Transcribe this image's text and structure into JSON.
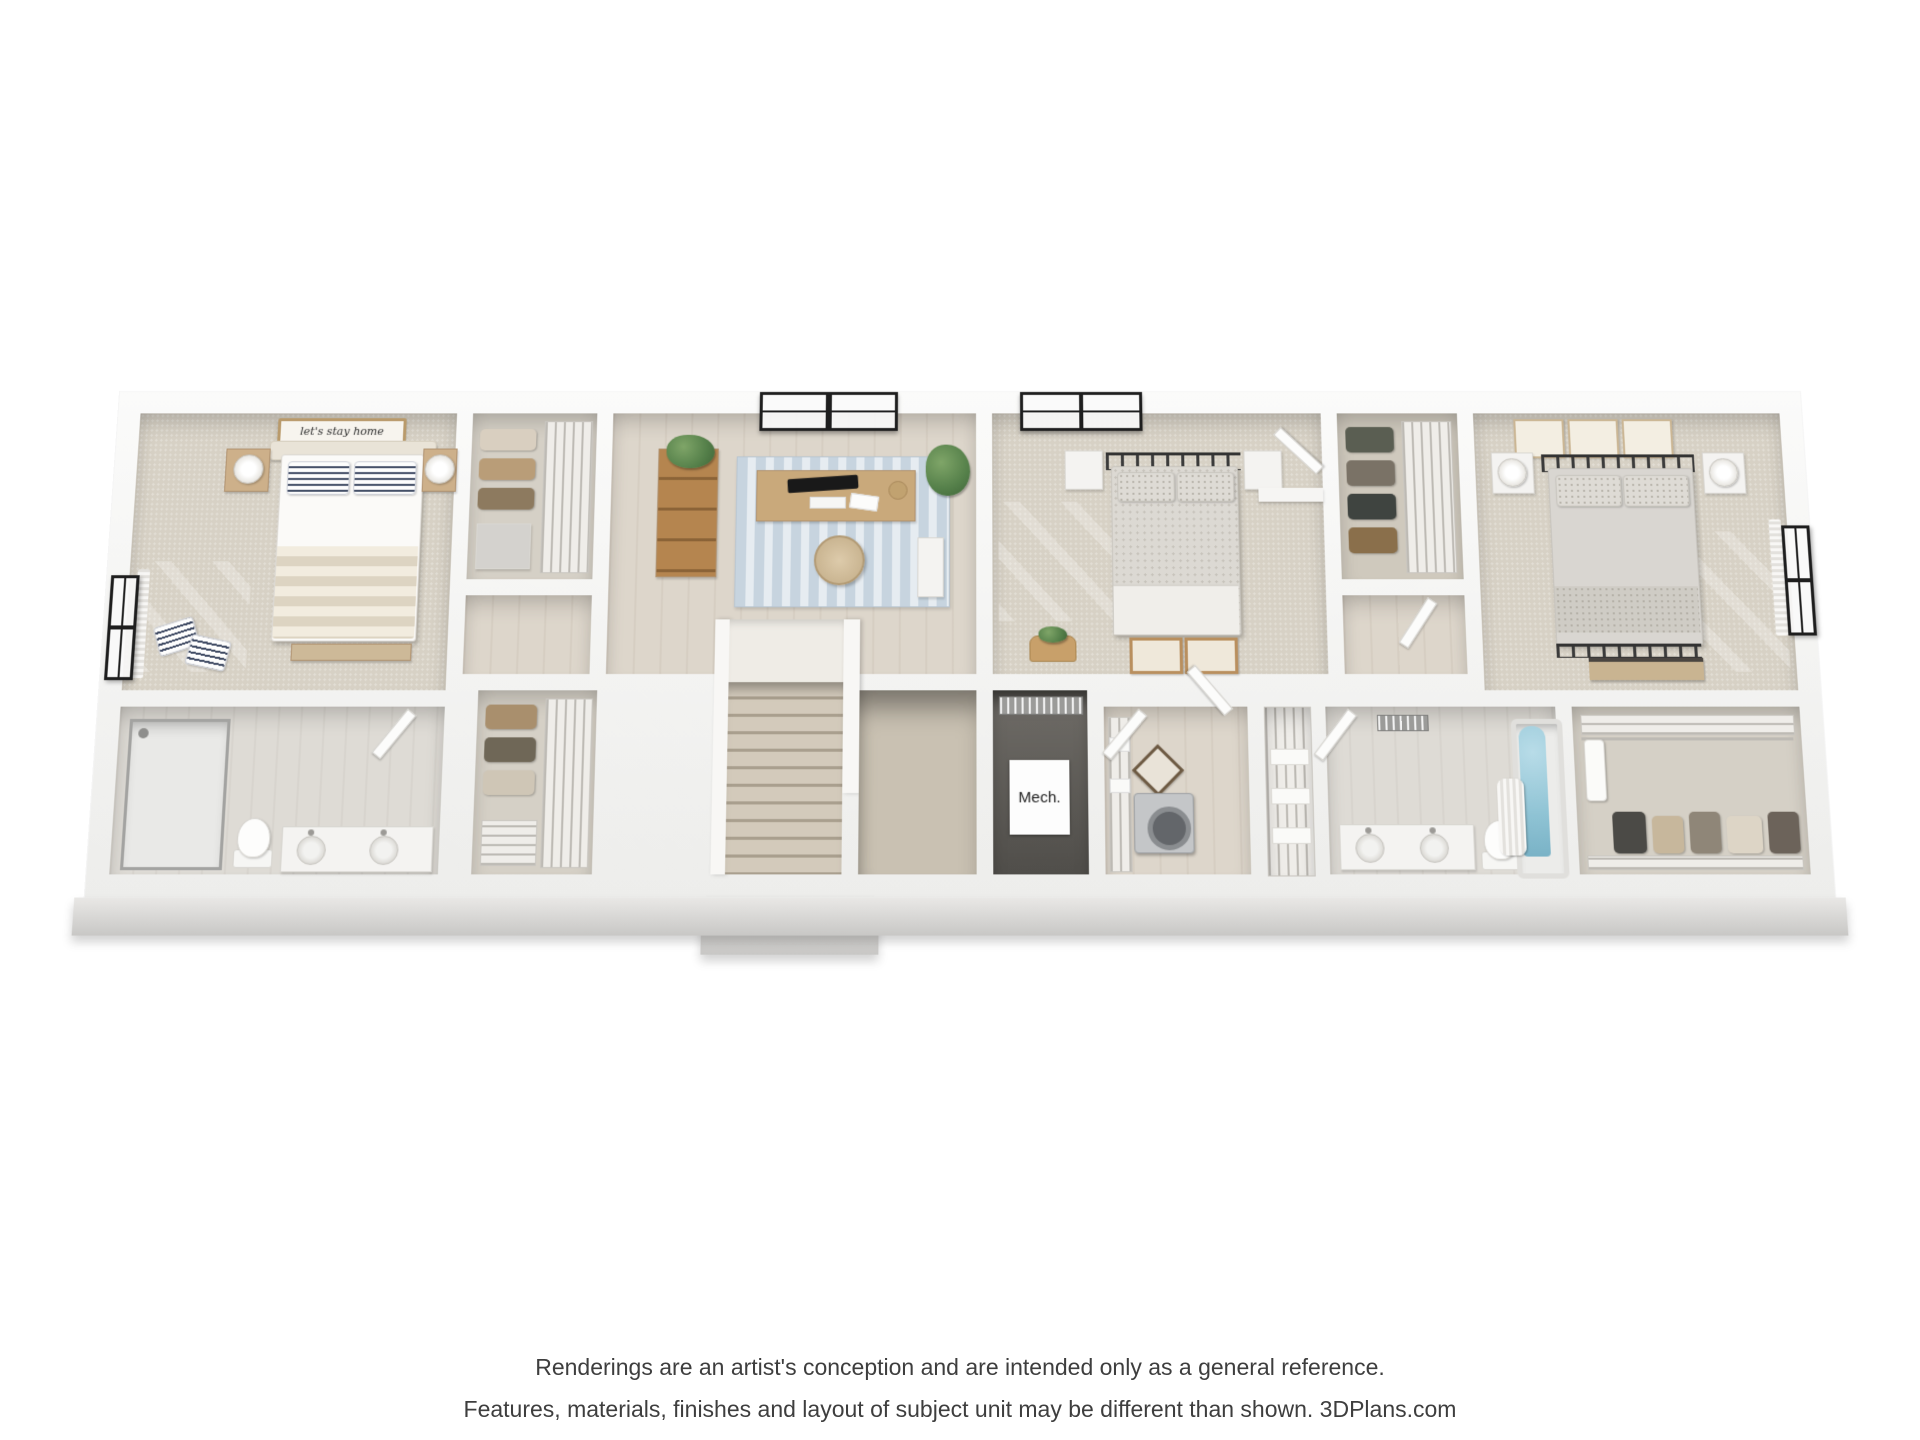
{
  "scene": {
    "type": "3d-cutaway-floorplan-rendering",
    "view": "aerial-oblique",
    "rooms": [
      {
        "name": "primary-bedroom",
        "furniture": [
          "upholstered-bed",
          "striped-pillows",
          "two-wood-nightstands-with-lamps",
          "wall-sign",
          "window",
          "foot-bench",
          "floor-pillows"
        ]
      },
      {
        "name": "primary-bathroom",
        "furniture": [
          "glass-shower",
          "toilet",
          "double-sink-vanity"
        ]
      },
      {
        "name": "walk-in-closet-top-left",
        "furniture": [
          "wire-shelving",
          "folded-clothes",
          "dresser"
        ]
      },
      {
        "name": "walk-in-closet-lower-left",
        "furniture": [
          "wire-shelving",
          "hanging-clothes",
          "shoe-rack"
        ]
      },
      {
        "name": "office-loft",
        "furniture": [
          "bookshelf-with-plant",
          "desk-with-monitor",
          "office-chair",
          "blue-striped-rug",
          "potted-plant",
          "window"
        ]
      },
      {
        "name": "staircase",
        "furniture": [
          "landing",
          "steps-down",
          "open-stairwell"
        ]
      },
      {
        "name": "mechanical-closet",
        "furniture": [
          "hvac-unit"
        ]
      },
      {
        "name": "bedroom-2",
        "furniture": [
          "metal-frame-bed",
          "two-white-nightstands",
          "window",
          "corner-closet-with-door",
          "wicker-basket",
          "leaning-frames"
        ]
      },
      {
        "name": "walk-in-closet-middle",
        "furniture": [
          "wire-shelving",
          "hanging-clothes"
        ]
      },
      {
        "name": "bedroom-3",
        "furniture": [
          "metal-frame-bed",
          "three-botanical-frames",
          "two-white-nightstands-with-lamps",
          "window",
          "console-bench"
        ]
      },
      {
        "name": "laundry-room",
        "furniture": [
          "double-doors",
          "washer",
          "wire-shelving",
          "picture-frame"
        ]
      },
      {
        "name": "linen-closet",
        "furniture": [
          "towel-stacks"
        ]
      },
      {
        "name": "hall-bathroom",
        "furniture": [
          "double-sink-vanity",
          "toilet",
          "bathtub-with-curtain",
          "ceiling-vent"
        ]
      },
      {
        "name": "walk-in-closet-right",
        "furniture": [
          "wire-shelving",
          "hanging-rod",
          "folded-clothes",
          "garment-steamer"
        ]
      }
    ]
  },
  "labels": {
    "mech_room": "Mech.",
    "bed_sign": "let's stay home"
  },
  "disclaimer": {
    "line1": "Renderings are an artist's conception and are intended only as a general reference.",
    "line2": "Features, materials, finishes and layout of subject unit may be different than shown. 3DPlans.com"
  },
  "colors": {
    "background": "#ffffff",
    "walls": "#f3f2f0",
    "carpet": "#d7d1c5",
    "wood_floor": "#ddd6cb",
    "bath_floor": "#dedbd5",
    "rug_blue": "#c7d4df",
    "tub_water": "#8fc3d4",
    "window_frame": "#1e1e1e",
    "disclaimer_text": "#3e3e3e"
  }
}
